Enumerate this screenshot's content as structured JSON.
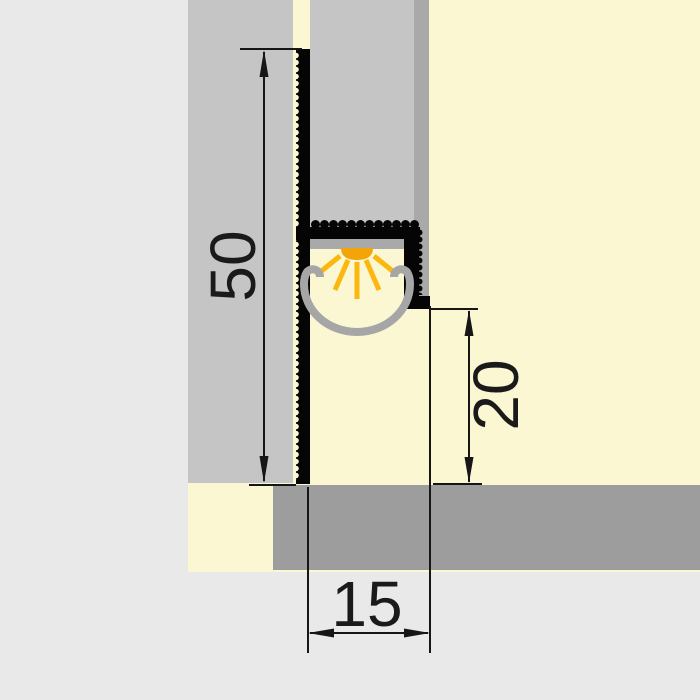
{
  "dimensions": {
    "height": {
      "label": "50"
    },
    "depth": {
      "label": "20"
    },
    "width": {
      "label": "15"
    }
  },
  "icons": {
    "led": "led-light-icon"
  },
  "colors": {
    "background-gray": "#e9e9e9",
    "plaster-cream": "#fbf7d2",
    "board-gray": "#c5c5c5",
    "board-edge-gray": "#a9a9a9",
    "band-gray": "#9d9d9d",
    "profile-black": "#050505",
    "plate-gray": "#a9a9a9",
    "diffuser-gray": "#a6a6a6",
    "led-orange": "#f2a408",
    "ray-yellow": "#fbb70e",
    "dimension-line": "#161616",
    "dimension-text": "#1a1a1a"
  }
}
